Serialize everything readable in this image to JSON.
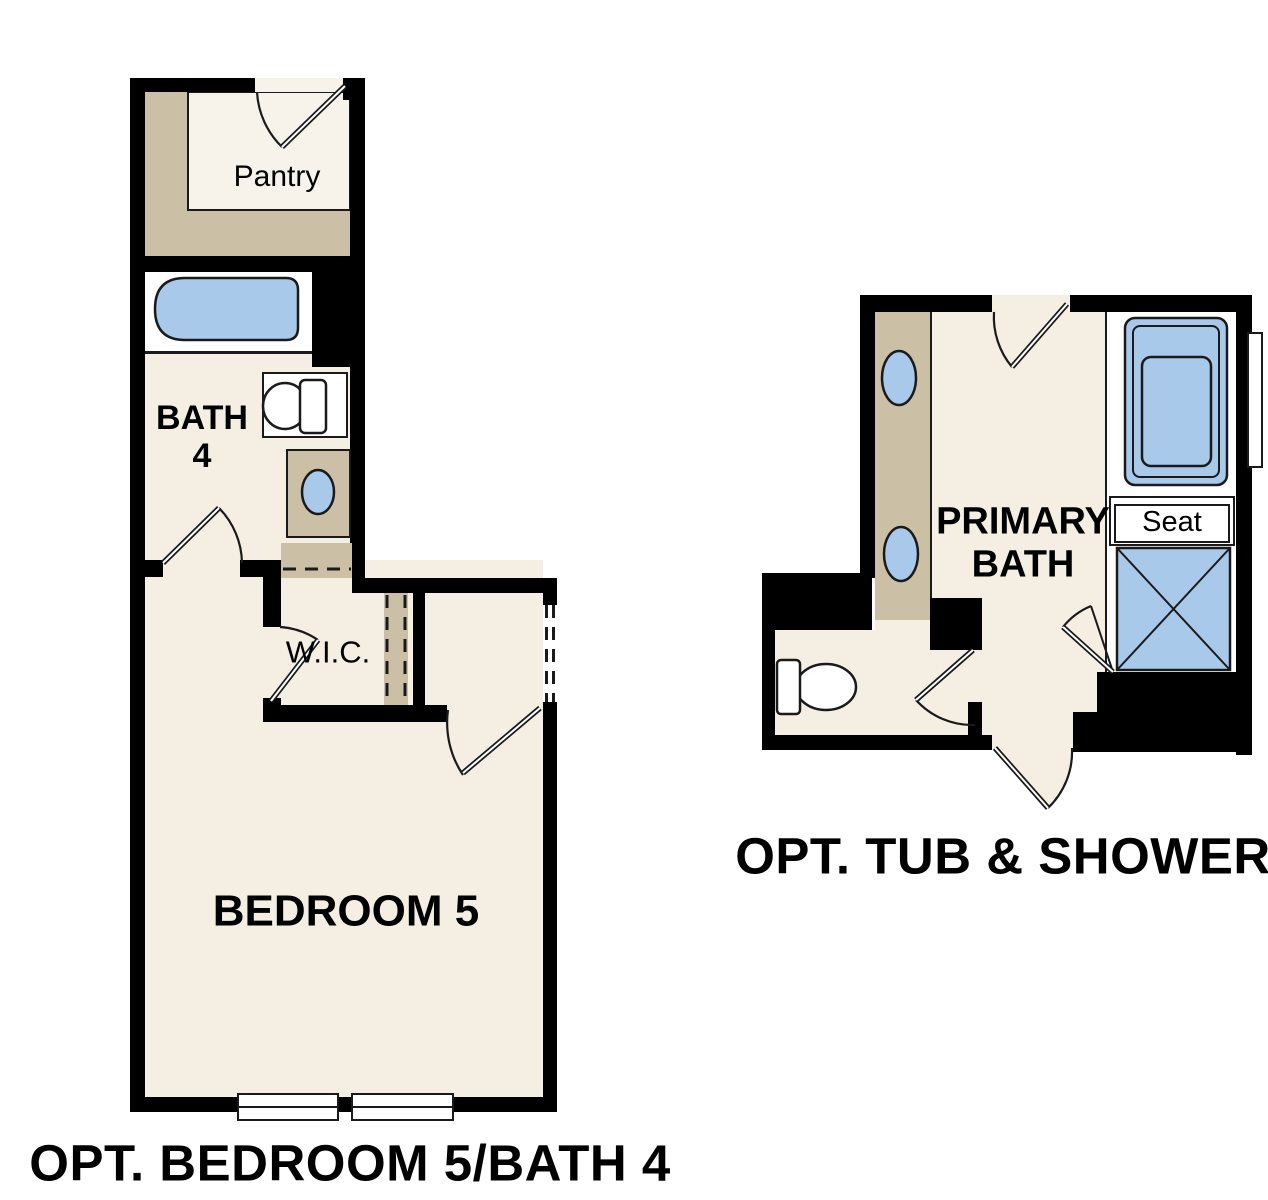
{
  "plans": {
    "left": {
      "title": "OPT. BEDROOM 5/BATH 4",
      "rooms": {
        "pantry": "Pantry",
        "bath": {
          "line1": "BATH",
          "line2": "4"
        },
        "wic": "W.I.C.",
        "bedroom": "BEDROOM 5"
      }
    },
    "right": {
      "title": "OPT. TUB & SHOWER",
      "rooms": {
        "primary_bath": {
          "line1": "PRIMARY",
          "line2": "BATH"
        },
        "seat": "Seat"
      }
    }
  },
  "colors": {
    "wall": "#000000",
    "floor": "#f5eee3",
    "floor_light": "#f8f3ea",
    "cabinet": "#cbbfa6",
    "fixture": "#a9c9ea",
    "white": "#ffffff",
    "line": "#1a1a1a",
    "text": "#000000"
  }
}
